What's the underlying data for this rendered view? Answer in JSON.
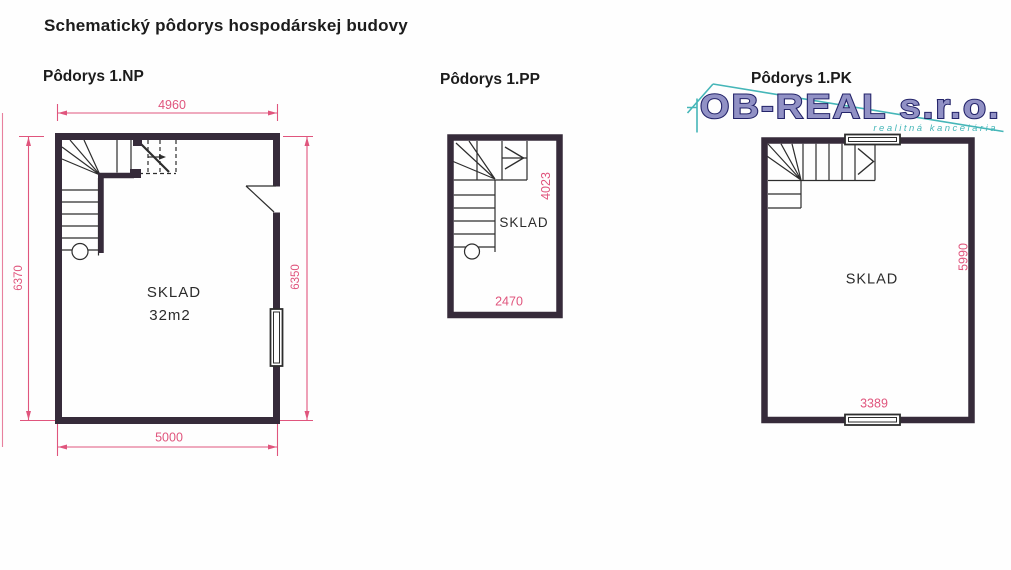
{
  "document_title": "Schematický pôdorys hospodárskej budovy",
  "colors": {
    "wall": "#362b3a",
    "line": "#2d2d2d",
    "dimension_pink": "#e0557d",
    "logo_purple": "#9191c5",
    "logo_outline": "#24246a",
    "logo_teal": "#45b6b8",
    "text": "#1c1c1c"
  },
  "plans": [
    {
      "title": "Pôdorys 1.NP",
      "room": {
        "label": "SKLAD",
        "area": "32m2"
      },
      "dimensions": {
        "top": "4960",
        "bottom": "5000",
        "left": "6370",
        "right": "6350"
      }
    },
    {
      "title": "Pôdorys 1.PP",
      "room": {
        "label": "SKLAD"
      },
      "dimensions": {
        "right": "4023",
        "bottom": "2470"
      }
    },
    {
      "title": "Pôdorys 1.PK",
      "room": {
        "label": "SKLAD"
      },
      "dimensions": {
        "right": "5990",
        "bottom": "3389"
      }
    }
  ],
  "logo": {
    "company": "OB-REAL s.r.o.",
    "tagline": "realitná kancelária"
  }
}
